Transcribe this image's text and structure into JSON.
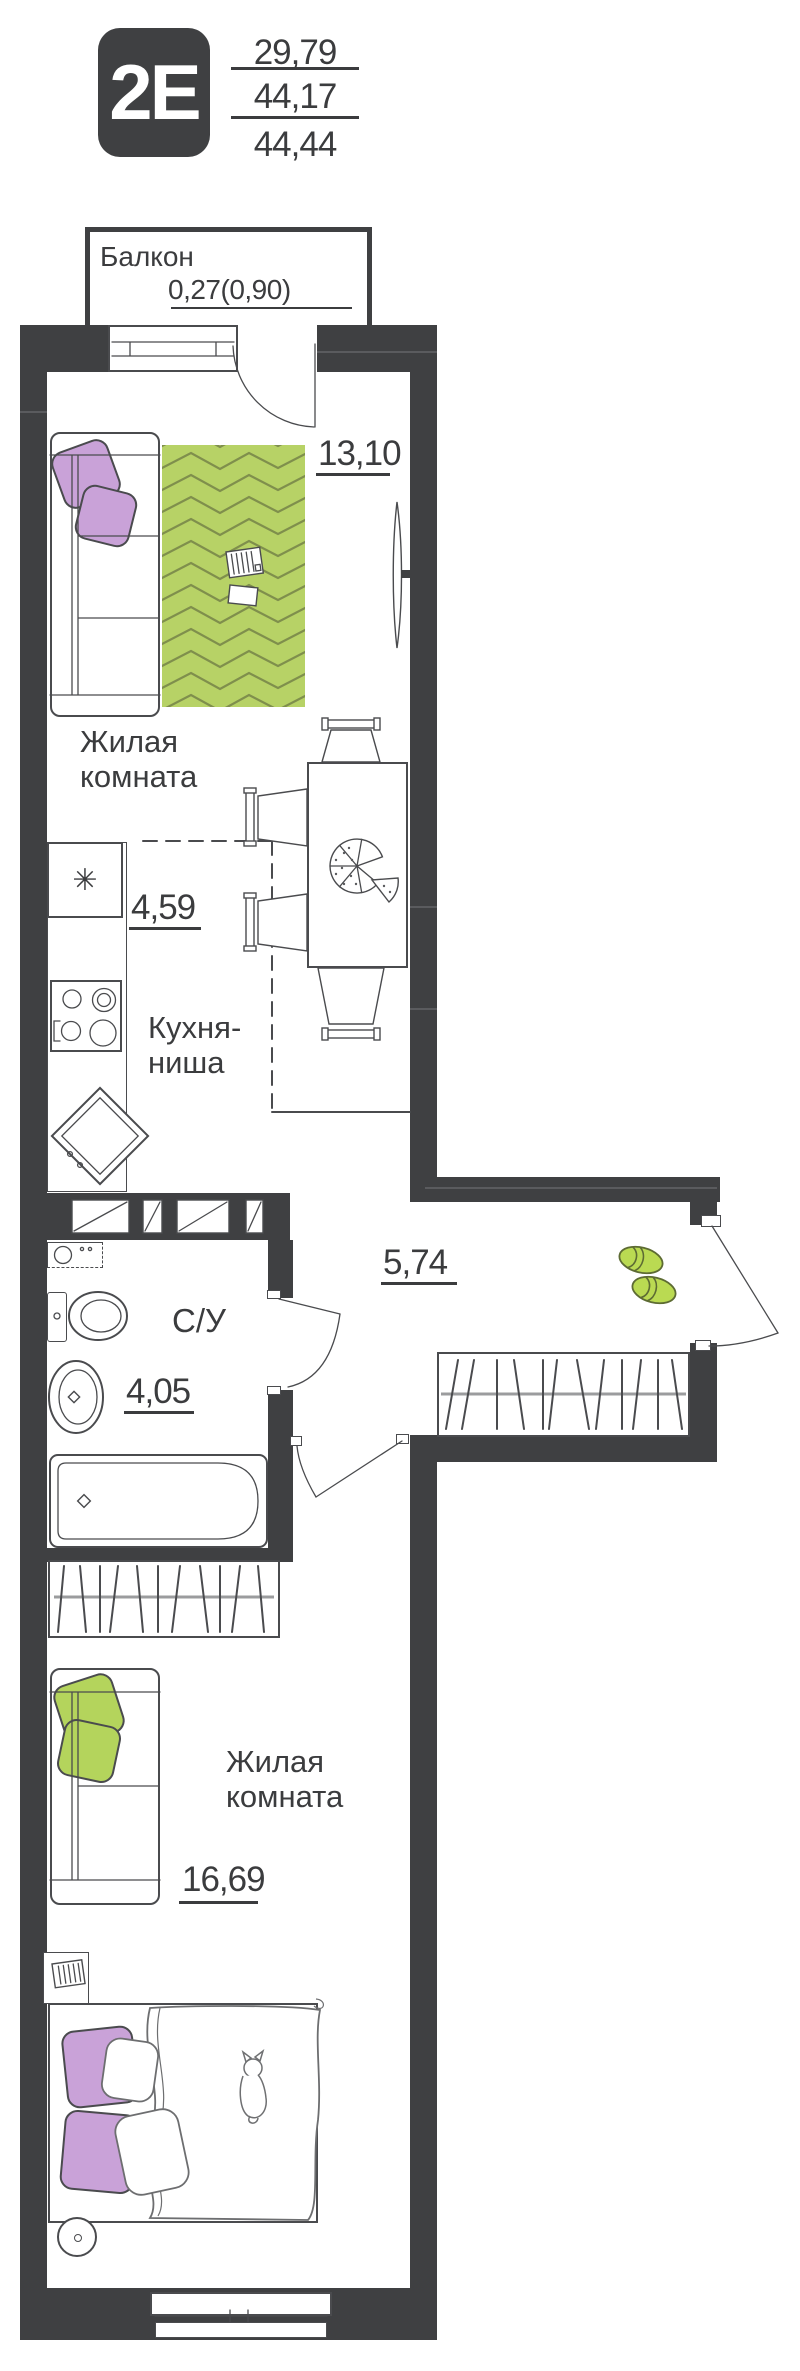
{
  "header": {
    "apartment_type": "2E",
    "area_values": [
      "29,79",
      "44,17",
      "44,44"
    ]
  },
  "balcony": {
    "label": "Балкон",
    "area": "0,27(0,90)"
  },
  "rooms": {
    "living_room_1": {
      "label": "Жилая\nкомната",
      "area": "13,10"
    },
    "kitchen_niche": {
      "label": "Кухня-\nниша",
      "area": "4,59"
    },
    "bathroom": {
      "label": "С/У",
      "area": "4,05"
    },
    "hallway": {
      "area": "5,74"
    },
    "living_room_2": {
      "label": "Жилая\nкомната",
      "area": "16,69"
    }
  },
  "symbols": {
    "fridge": "✳"
  },
  "colors": {
    "wall": "#3f4042",
    "outline": "#4a4b4e",
    "text": "#3b3c3e",
    "rug_green": "#b7d266",
    "rug_line": "#7f8f4c",
    "pillow_purple": "#c9a2d8",
    "pillow_green": "#b4d45c",
    "slipper_green": "#bada52"
  }
}
